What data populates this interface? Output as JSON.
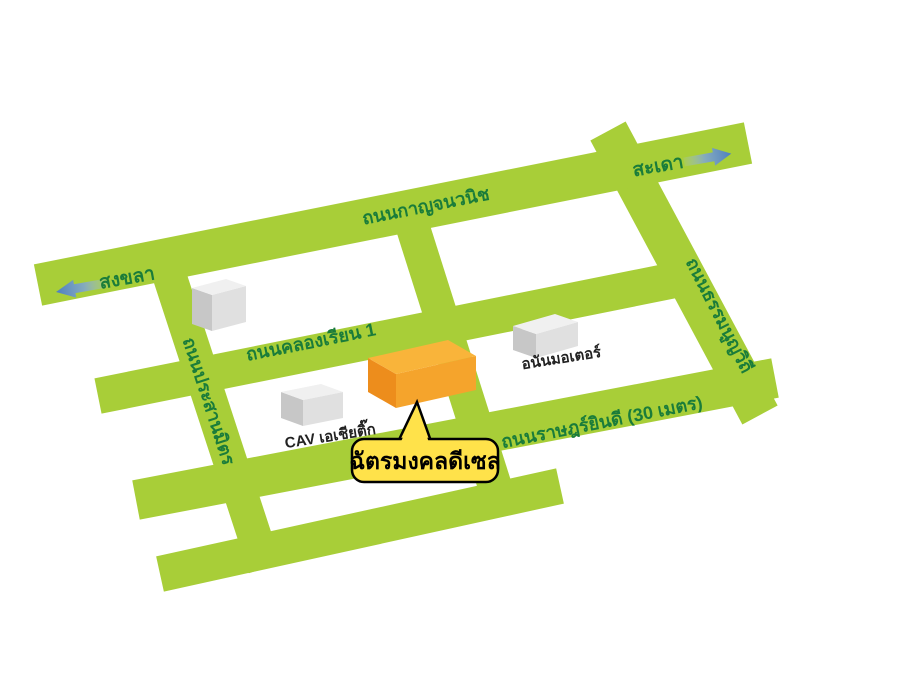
{
  "map": {
    "background_color": "#ffffff",
    "road_color": "#a8ce38",
    "road_label_color": "#1a7c3a",
    "roads": {
      "kanchanavanich": {
        "label": "ถนนกาญจนวนิช"
      },
      "khlong_rian_1": {
        "label": "ถนนคลองเรียน 1"
      },
      "ratyindi": {
        "label": "ถนนราษฎร์ยินดี (30 เมตร)"
      },
      "thammanoon_withi": {
        "label": "ถนนธรรมนูญวิถี"
      },
      "prasanmit": {
        "label": "ถนนประสานมิตร"
      }
    },
    "directions": {
      "arrow_color": "#4d7fc0",
      "west": {
        "label": "สงขลา"
      },
      "east": {
        "label": "สะเดา"
      }
    },
    "buildings": {
      "gray_color_top": "#f0f0f0",
      "gray_color_front": "#e0e0e0",
      "gray_color_side": "#c7c7c7",
      "cav": {
        "label": "CAV เอเชียติ๊ก"
      },
      "anan": {
        "label": "อนันมอเตอร์"
      }
    },
    "destination": {
      "label": "ฉัตรมงคลดีเซล",
      "building_color": "#f9b43a",
      "callout_color": "#ffe24a",
      "callout_border_color": "#000000"
    }
  }
}
